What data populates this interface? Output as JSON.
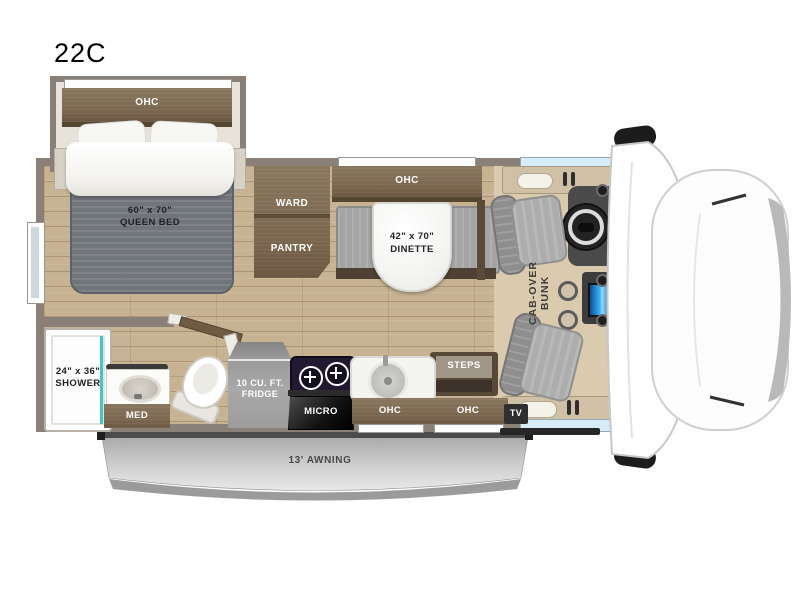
{
  "title": "22C",
  "floorplan": {
    "bedroom": {
      "ohc": "OHC",
      "bed_size": "60\" x 70\"",
      "bed_name": "QUEEN BED"
    },
    "storage": {
      "ward": "WARD",
      "pantry": "PANTRY"
    },
    "dinette": {
      "ohc": "OHC",
      "size": "42\" x 70\"",
      "name": "DINETTE"
    },
    "cab": {
      "bunk_line1": "CAB-OVER",
      "bunk_line2": "BUNK",
      "tv": "TV",
      "steps": "STEPS"
    },
    "bathroom": {
      "shower_size": "24\" x 36\"",
      "shower_name": "SHOWER",
      "med": "MED"
    },
    "kitchen": {
      "fridge_line1": "10 CU. FT.",
      "fridge_line2": "FRIDGE",
      "micro": "MICRO",
      "ohc": "OHC",
      "entry_ohc": "OHC"
    },
    "exterior": {
      "awning": "13' AWNING"
    }
  },
  "colors": {
    "wall": "#8A8078",
    "cabinet_brown": "#7A664E",
    "floor_wood": "#C7B291",
    "cab_floor_tan": "#DBCBAE",
    "mattress_gray": "#70747B",
    "shower_teal": "#3CC8CD",
    "dash_screen_blue": "#2F9BE8",
    "awning_gray": "#C6C6C6",
    "window_blue": "#D6ECF6"
  }
}
